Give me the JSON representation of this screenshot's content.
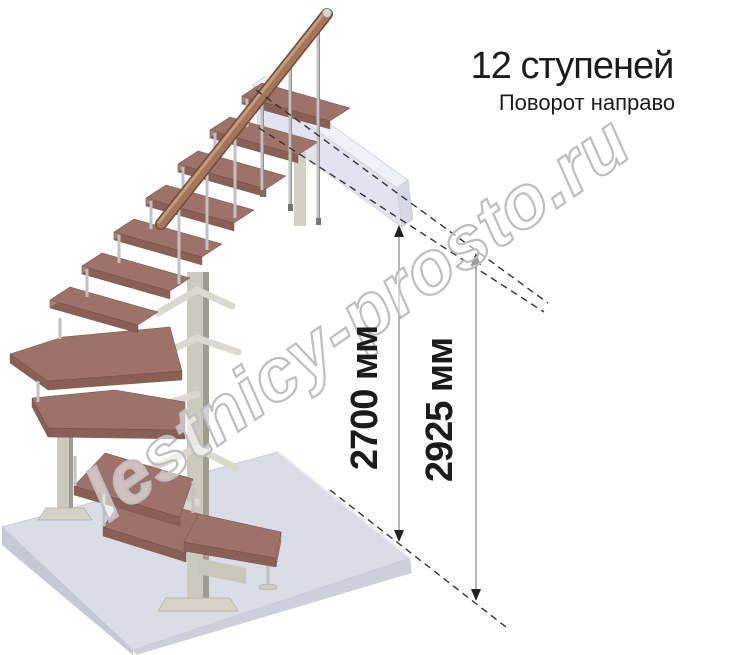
{
  "header": {
    "title": "12 ступеней",
    "subtitle": "Поворот направо"
  },
  "dimensions": {
    "ceiling": {
      "label": "2700 мм"
    },
    "floor_to_floor": {
      "label": "2925 мм"
    }
  },
  "watermark": {
    "text": "lestnicy-prosto.ru"
  },
  "colors": {
    "wood_tread": "#9e7269",
    "handrail": "#a5755a",
    "metal_baluster": "#c4c4c4",
    "support_column": "#ccc9bd",
    "floor_slab": "#dadce6",
    "landing_block": "#ccd2e3",
    "dimension_text": "#1b1b1b",
    "watermark_outline": "#bdbdc2"
  }
}
